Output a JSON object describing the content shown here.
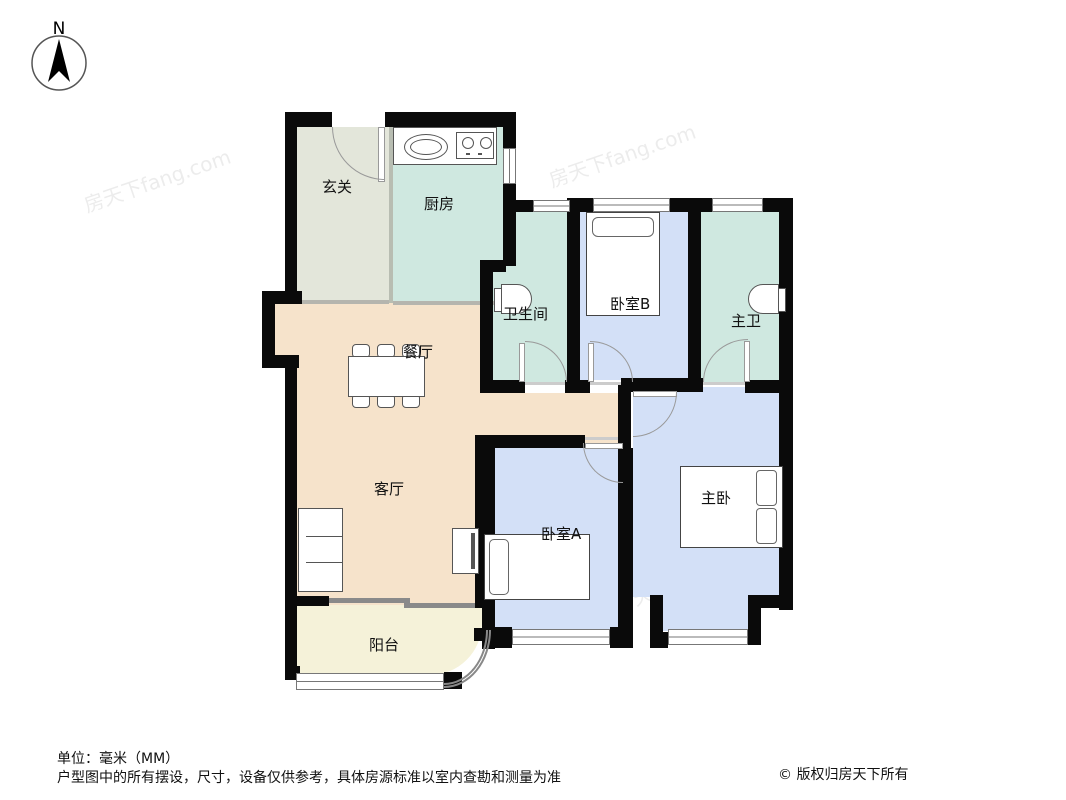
{
  "compass": {
    "label": "N"
  },
  "rooms": {
    "foyer": {
      "label": "玄关"
    },
    "kitchen": {
      "label": "厨房"
    },
    "bathroom": {
      "label": "卫生间"
    },
    "bedroom_b": {
      "label": "卧室B"
    },
    "master_bath": {
      "label": "主卫"
    },
    "dining": {
      "label": "餐厅"
    },
    "living": {
      "label": "客厅"
    },
    "bedroom_a": {
      "label": "卧室A"
    },
    "master_bedroom": {
      "label": "主卧"
    },
    "balcony": {
      "label": "阳台"
    }
  },
  "colors": {
    "wall": "#0a0a0a",
    "sage": "#e3e6da",
    "teal": "#cfe8e0",
    "blue": "#d3e0f7",
    "beige": "#f6e3cb",
    "cream": "#f5f2d9"
  },
  "watermark": {
    "text": "房天下fang.com"
  },
  "footer": {
    "unit": "单位：毫米（MM）",
    "disclaimer": "户型图中的所有摆设，尺寸，设备仅供参考，具体房源标准以室内查勘和测量为准",
    "copyright": "© 版权归房天下所有"
  }
}
